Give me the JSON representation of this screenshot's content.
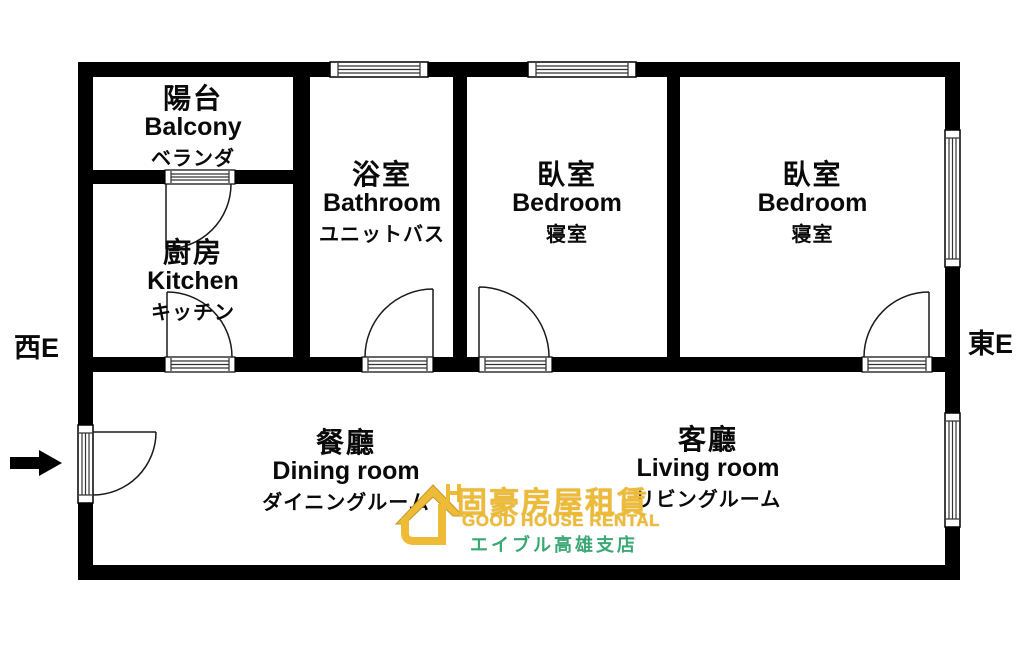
{
  "compass": {
    "west_label": "西E",
    "east_label": "東E"
  },
  "rooms": {
    "balcony": {
      "zh": "陽台",
      "en": "Balcony",
      "ja": "ベランダ"
    },
    "kitchen": {
      "zh": "廚房",
      "en": "Kitchen",
      "ja": "キッチン"
    },
    "bathroom": {
      "zh": "浴室",
      "en": "Bathroom",
      "ja": "ユニットバス"
    },
    "bedroom1": {
      "zh": "臥室",
      "en": "Bedroom",
      "ja": "寝室"
    },
    "bedroom2": {
      "zh": "臥室",
      "en": "Bedroom",
      "ja": "寝室"
    },
    "dining": {
      "zh": "餐廳",
      "en": "Dining room",
      "ja": "ダイニングルーム"
    },
    "living": {
      "zh": "客廳",
      "en": "Living room",
      "ja": "リビングルーム"
    }
  },
  "logo": {
    "name_zh": "固豪房屋租賃",
    "name_en": "GOOD HOUSE RENTAL",
    "branch_ja": "エイブル高雄支店",
    "colors": {
      "yellow": "#EDBB35",
      "green": "#3BA874"
    }
  },
  "plan": {
    "wall_color": "#000000",
    "background": "#FFFFFF"
  }
}
